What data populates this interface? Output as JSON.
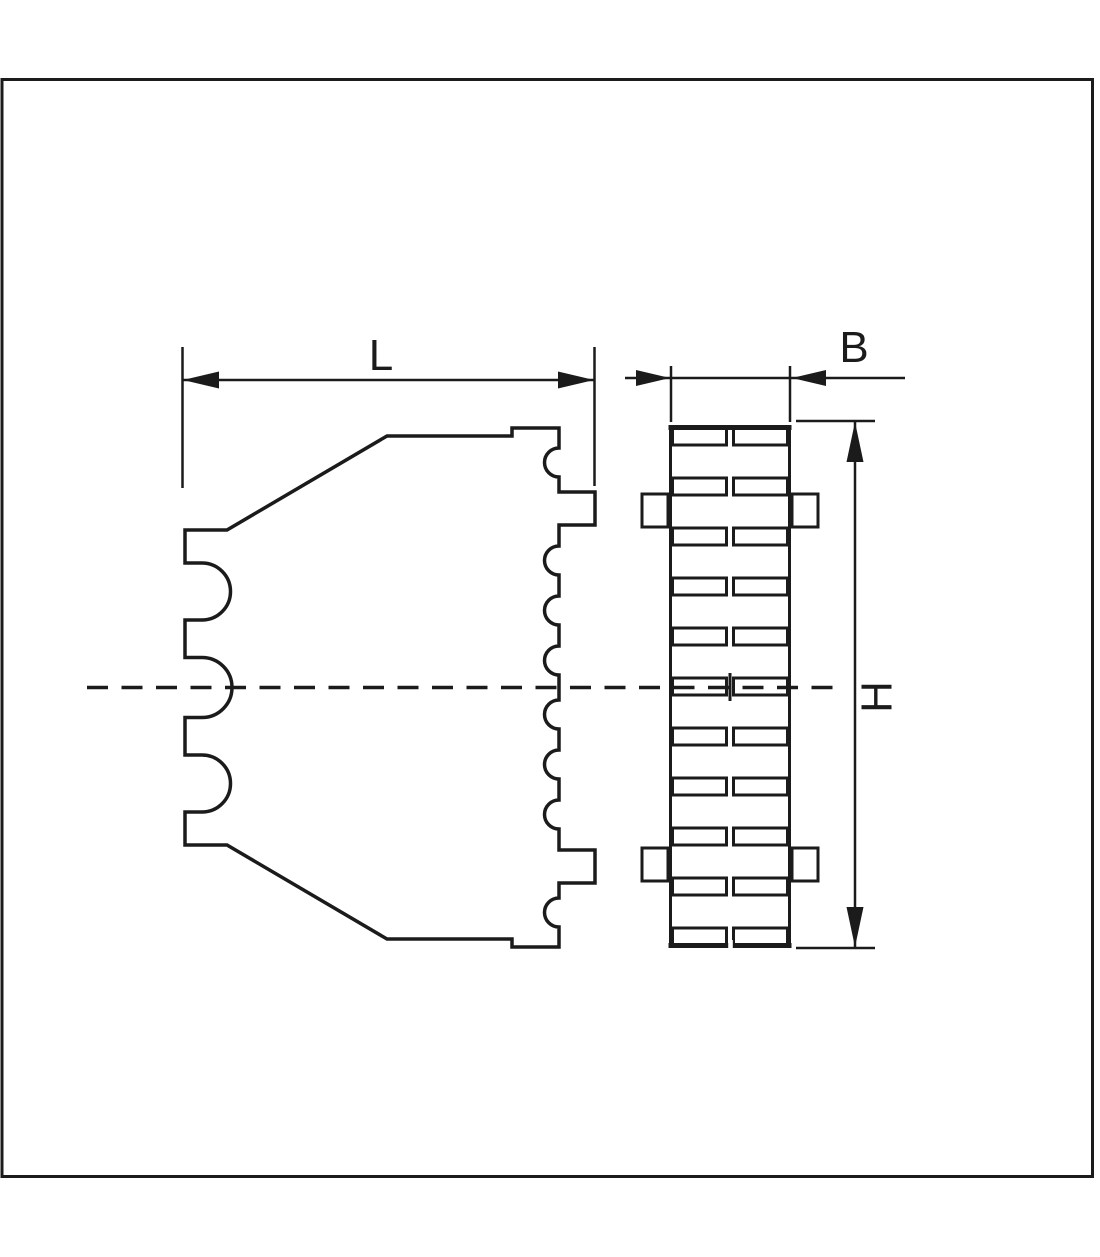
{
  "page": {
    "background": "#ffffff"
  },
  "drawing": {
    "ink_color": "#1b1b1b",
    "dimension_labels": {
      "length": "L",
      "width": "B",
      "height": "H"
    },
    "front_view": {
      "rows": 11,
      "columns": 2,
      "side_tabs": 4
    },
    "side_view": {
      "left_notches": 3,
      "right_notches": 8,
      "right_tabs": 2
    }
  }
}
